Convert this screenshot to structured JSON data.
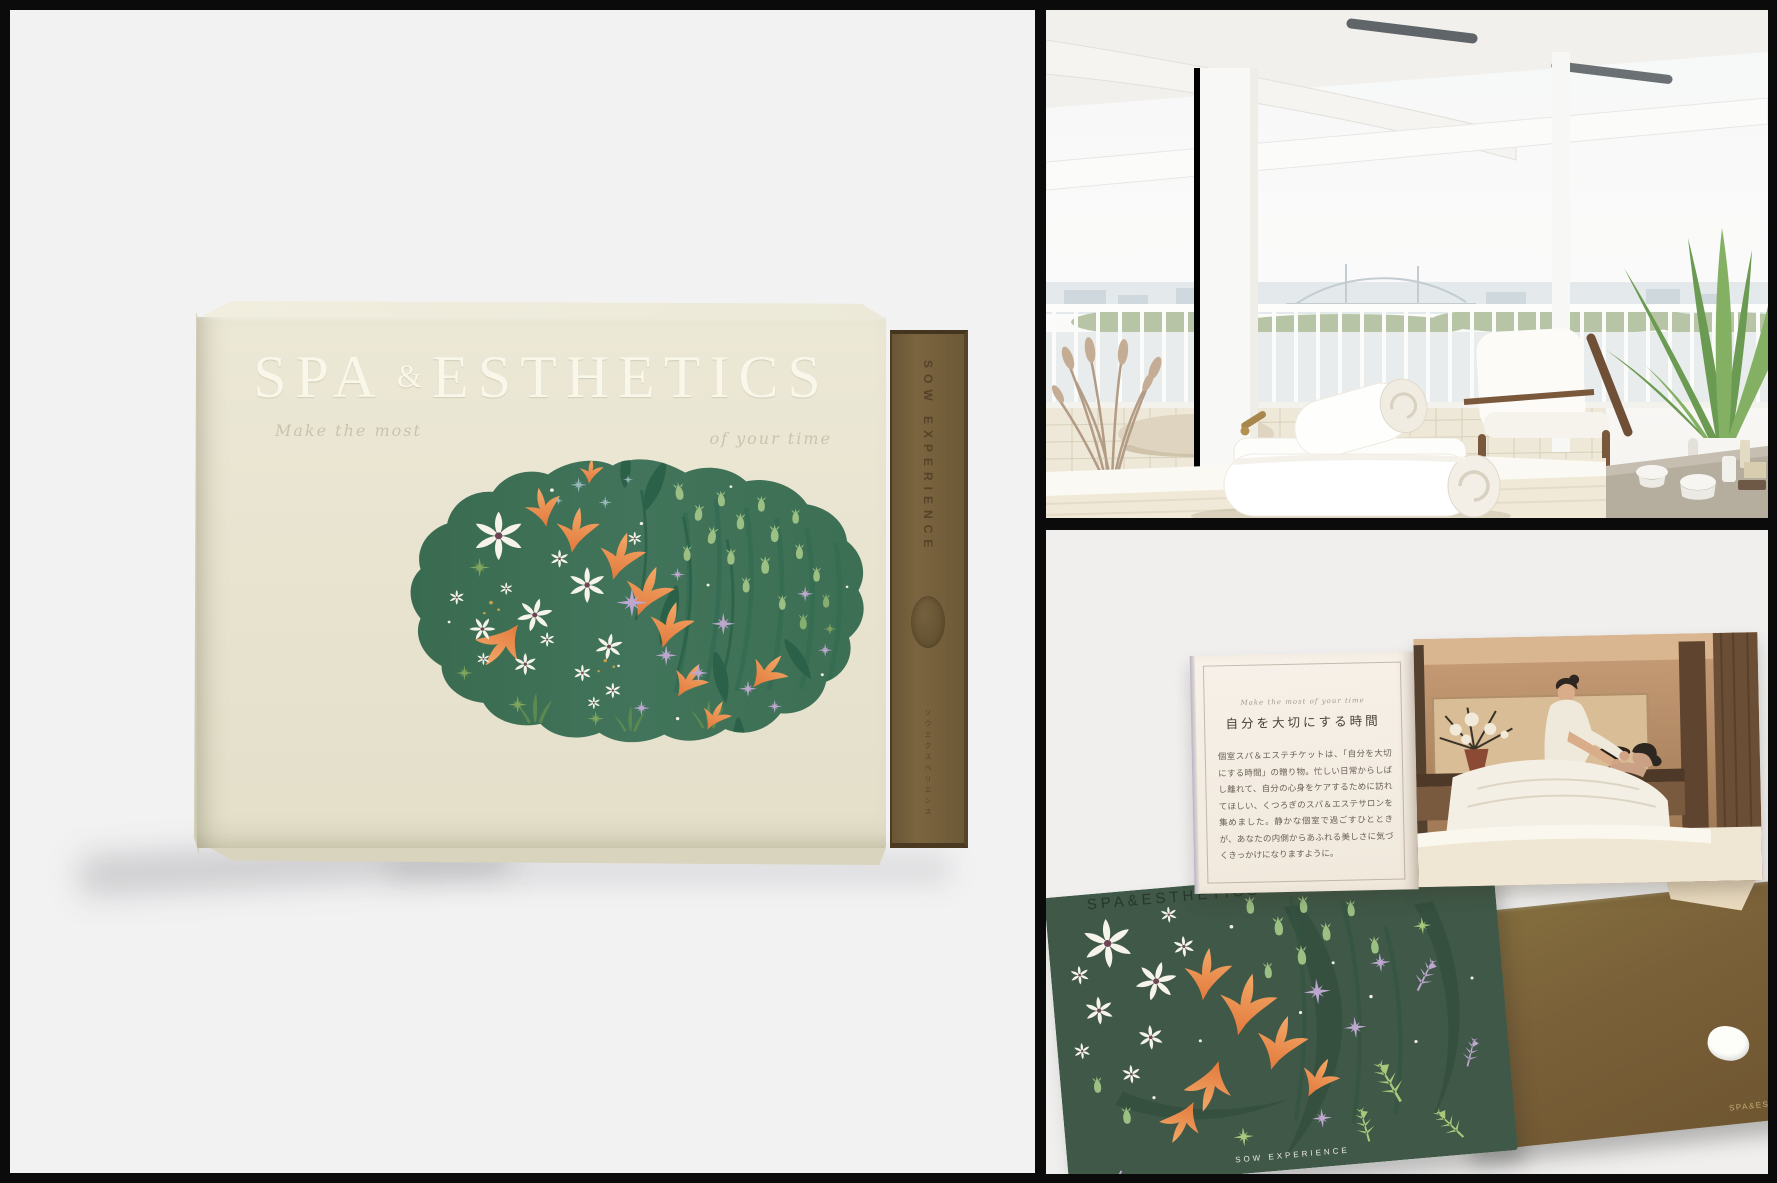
{
  "colors": {
    "frame_black": "#0b0b0b",
    "panel_gray": "#f2f2f3",
    "box_cream": "#e9e5d1",
    "spine_brown": "#76613c",
    "illustration_green": "#3e7156",
    "card_green": "#3f5847",
    "envelope_brown": "#7b6139",
    "accent_orange": "#ea8f4f",
    "accent_lavender": "#bda7cf",
    "flower_white": "#f5f3ea",
    "bud_green": "#9cc083"
  },
  "box": {
    "title_spa": "SPA",
    "title_amp": "&",
    "title_esthetics": "ESTHETICS",
    "tagline_left": "Make the most",
    "tagline_right": "of your time",
    "spine_brand": "SOW EXPERIENCE",
    "spine_jp": "ソウエクスペリエンス"
  },
  "booklet": {
    "script_line": "Make the most of your time",
    "heading": "自分を大切にする時間",
    "body": "個室スパ＆エステチケットは、「自分を大切にする時間」の贈り物。忙しい日常からしばし離れて、自分の心身をケアするために訪れてほしい、くつろぎのスパ＆エステサロンを集めました。静かな個室で過ごすひとときが、あなたの内側からあふれる美しさに気づくきっかけになりますように。"
  },
  "card": {
    "brand": "SPA&ESTHETICS",
    "footer": "SOW EXPERIENCE"
  },
  "envelope": {
    "brand": "SPA&ESTHETICS"
  }
}
